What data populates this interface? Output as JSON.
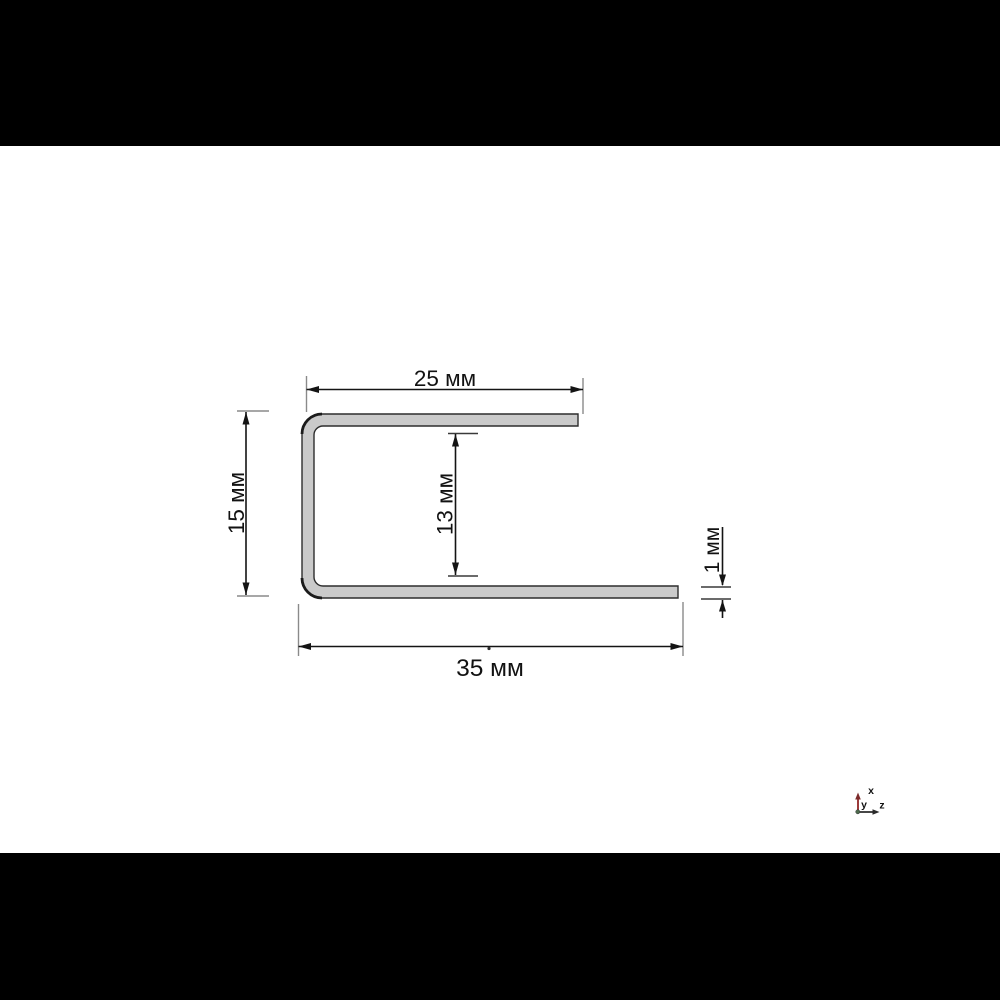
{
  "meta": {
    "description": "CAD viewer screenshot of a J-shaped sheet-metal profile cross-section with dimensions",
    "background_color": "#ffffff",
    "letterbox_color": "#000000"
  },
  "drawing": {
    "profile": {
      "name": "j-profile-cross-section",
      "fill_color": "#cacaca",
      "outline_color": "#2d2d2d"
    },
    "colors": {
      "dimension_line": "#141414",
      "extension_line": "#8a8a8a",
      "tick_line": "#3a3a3a"
    },
    "dimensions": [
      {
        "id": "top-flange-width",
        "label": "25 мм",
        "value": 25,
        "unit": "мм",
        "orientation": "horizontal"
      },
      {
        "id": "outer-height",
        "label": "15 мм",
        "value": 15,
        "unit": "мм",
        "orientation": "vertical"
      },
      {
        "id": "inner-height",
        "label": "13 мм",
        "value": 13,
        "unit": "мм",
        "orientation": "vertical"
      },
      {
        "id": "material-thickness",
        "label": "1 мм",
        "value": 1,
        "unit": "мм",
        "orientation": "vertical"
      },
      {
        "id": "bottom-flange-width",
        "label": "35 мм",
        "value": 35,
        "unit": "мм",
        "orientation": "horizontal"
      }
    ],
    "axis_triad": {
      "labels": {
        "x": "x",
        "y": "y",
        "z": "z"
      },
      "colors": {
        "x_axis": "#9c3b3b",
        "x_head": "#7c2b2b",
        "z_axis": "#474747",
        "z_head": "#2a2a2a",
        "origin": "#4d6a4d",
        "label": "#111111"
      }
    }
  }
}
